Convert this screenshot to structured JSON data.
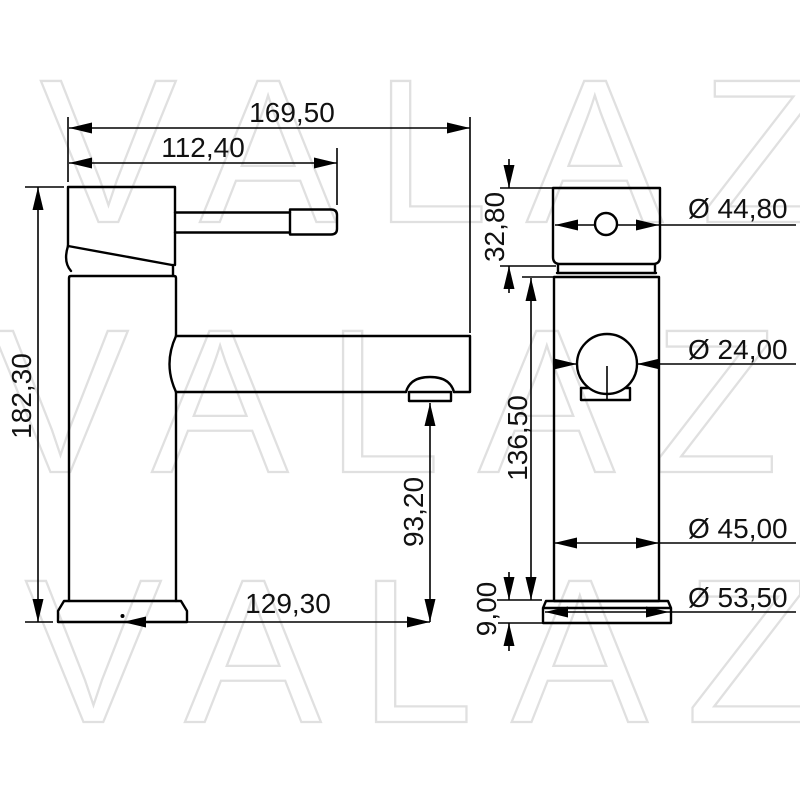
{
  "watermark": {
    "text": "VALAZ",
    "color": "#e0e0e0"
  },
  "style": {
    "line_color": "#000000",
    "dim_text_color": "#111111",
    "background": "#ffffff"
  },
  "views": {
    "side": {
      "dims": {
        "overall_width": "169,50",
        "handle_reach": "112,40",
        "overall_height": "182,30",
        "outlet_height": "93,20",
        "spout_reach": "129,30"
      }
    },
    "front": {
      "dims": {
        "head_height": "32,80",
        "head_diameter": "Ø 44,80",
        "spout_diameter": "Ø 24,00",
        "body_height": "136,50",
        "body_diameter": "Ø 45,00",
        "base_height": "9,00",
        "base_diameter": "Ø 53,50"
      }
    }
  }
}
